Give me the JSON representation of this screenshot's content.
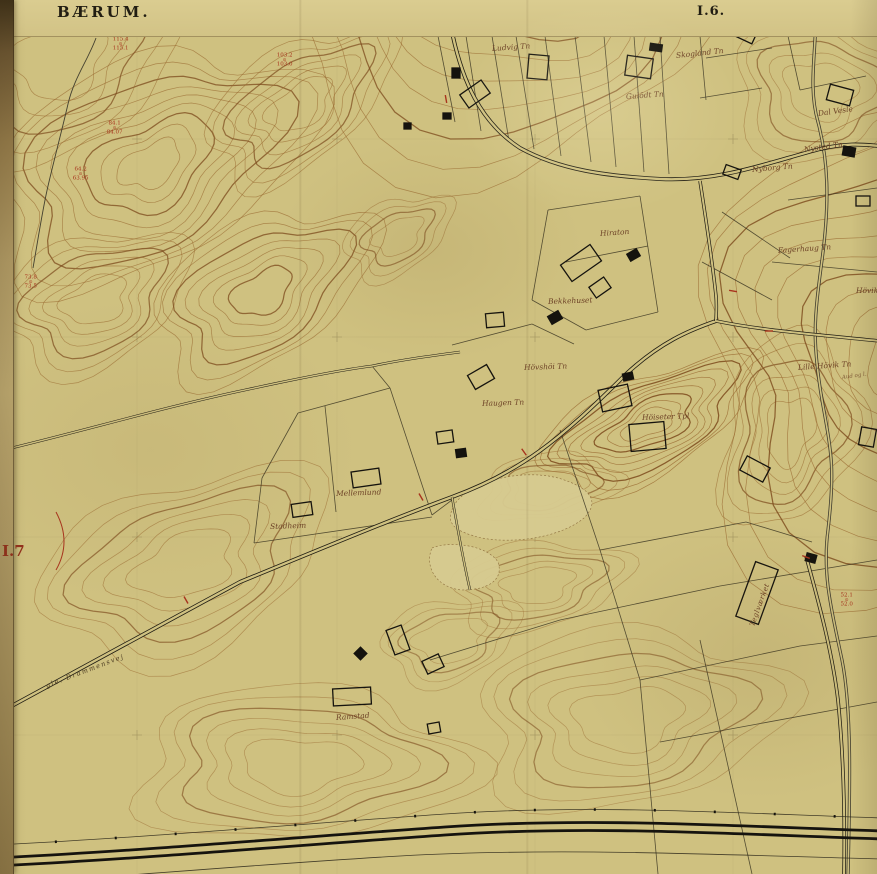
{
  "header": {
    "region_title": "BÆRUM.",
    "sheet_label": "I.6.",
    "adjacent_sheet_label": "I.7"
  },
  "map": {
    "colors": {
      "paper": "#cfc180",
      "contour": "#9a6a30",
      "contour_index": "#7c4a1c",
      "ink": "#1f1c12",
      "benchmark_red": "#a8331d",
      "label_brown": "#6d4226"
    },
    "place_labels": [
      {
        "text": "Ludvig Tn",
        "x": 492,
        "y": 44,
        "rot": -4,
        "cls": "p"
      },
      {
        "text": "Skogland Tn",
        "x": 676,
        "y": 51,
        "rot": -6,
        "cls": "p"
      },
      {
        "text": "Gulödt Tn",
        "x": 626,
        "y": 92,
        "rot": -4,
        "cls": "p"
      },
      {
        "text": "Dal Vesle",
        "x": 818,
        "y": 109,
        "rot": -8,
        "cls": "p"
      },
      {
        "text": "Nysted Tn",
        "x": 804,
        "y": 145,
        "rot": -8,
        "cls": "p"
      },
      {
        "text": "Nyborg Tn",
        "x": 752,
        "y": 165,
        "rot": -5,
        "cls": "p"
      },
      {
        "text": "Fagerhaug Tn",
        "x": 778,
        "y": 246,
        "rot": -4,
        "cls": "p"
      },
      {
        "text": "Hövik",
        "x": 856,
        "y": 286,
        "rot": 0,
        "cls": "p"
      },
      {
        "text": "Hiraton",
        "x": 600,
        "y": 229,
        "rot": -4,
        "cls": "p"
      },
      {
        "text": "Bekkehuset",
        "x": 548,
        "y": 297,
        "rot": -2,
        "cls": "p"
      },
      {
        "text": "Hövshöi Tn",
        "x": 524,
        "y": 363,
        "rot": -2,
        "cls": "p"
      },
      {
        "text": "Haugen Tn",
        "x": 482,
        "y": 399,
        "rot": -2,
        "cls": "p"
      },
      {
        "text": "Höiseter Tpl",
        "x": 642,
        "y": 413,
        "rot": -2,
        "cls": "p"
      },
      {
        "text": "Lille Hövik Tn",
        "x": 798,
        "y": 363,
        "rot": -4,
        "cls": "p"
      },
      {
        "text": "Aud og l.",
        "x": 842,
        "y": 375,
        "rot": -8,
        "cls": "ps"
      },
      {
        "text": "Mellemlund",
        "x": 336,
        "y": 489,
        "rot": -2,
        "cls": "p"
      },
      {
        "text": "Stadheim",
        "x": 270,
        "y": 522,
        "rot": -2,
        "cls": "p"
      },
      {
        "text": "Ramstad",
        "x": 336,
        "y": 713,
        "rot": -4,
        "cls": "p"
      },
      {
        "text": "Teglværket",
        "x": 752,
        "y": 622,
        "rot": -70,
        "cls": "pv"
      },
      {
        "text": "gle. Drammensvej",
        "x": 46,
        "y": 682,
        "rot": -21,
        "cls": "road"
      }
    ],
    "benchmarks": [
      {
        "x": 112,
        "y": 36,
        "top": "115.4",
        "bottom": "115.1"
      },
      {
        "x": 276,
        "y": 52,
        "top": "103.2",
        "bottom": "103.0"
      },
      {
        "x": 106,
        "y": 120,
        "top": "84.1",
        "bottom": "84.07"
      },
      {
        "x": 72,
        "y": 166,
        "top": "64.2",
        "bottom": "63.95"
      },
      {
        "x": 24,
        "y": 274,
        "top": "73.8",
        "bottom": "73.5"
      },
      {
        "x": 840,
        "y": 592,
        "top": "52.1",
        "bottom": "52.0"
      }
    ],
    "red_ticks": [
      {
        "x": 186,
        "y": 600,
        "r": 60
      },
      {
        "x": 421,
        "y": 497,
        "r": 60
      },
      {
        "x": 524,
        "y": 452,
        "r": 55
      },
      {
        "x": 733,
        "y": 291,
        "r": 10
      },
      {
        "x": 769,
        "y": 331,
        "r": 0
      },
      {
        "x": 806,
        "y": 557,
        "r": 20
      },
      {
        "x": 446,
        "y": 99,
        "r": 80
      }
    ],
    "buildings": [
      [
        452,
        68,
        8,
        10,
        0,
        1
      ],
      [
        462,
        86,
        26,
        16,
        -35,
        0
      ],
      [
        528,
        55,
        20,
        24,
        5,
        0
      ],
      [
        626,
        57,
        26,
        20,
        8,
        0
      ],
      [
        650,
        44,
        12,
        7,
        8,
        1
      ],
      [
        730,
        25,
        26,
        14,
        25,
        0
      ],
      [
        724,
        167,
        16,
        10,
        20,
        0
      ],
      [
        828,
        87,
        24,
        16,
        15,
        0
      ],
      [
        843,
        147,
        12,
        9,
        10,
        1
      ],
      [
        856,
        196,
        14,
        10,
        0,
        0
      ],
      [
        443,
        113,
        8,
        6,
        0,
        1
      ],
      [
        404,
        123,
        7,
        6,
        0,
        1
      ],
      [
        563,
        253,
        36,
        20,
        -35,
        0
      ],
      [
        628,
        251,
        11,
        8,
        -30,
        1
      ],
      [
        591,
        281,
        18,
        13,
        -35,
        0
      ],
      [
        486,
        313,
        18,
        14,
        -5,
        0
      ],
      [
        549,
        313,
        12,
        9,
        -30,
        1
      ],
      [
        470,
        369,
        22,
        16,
        -30,
        0
      ],
      [
        437,
        431,
        16,
        12,
        -8,
        0
      ],
      [
        456,
        449,
        10,
        8,
        -8,
        1
      ],
      [
        600,
        387,
        30,
        22,
        -12,
        0
      ],
      [
        623,
        373,
        10,
        7,
        -12,
        1
      ],
      [
        630,
        423,
        35,
        27,
        -5,
        0
      ],
      [
        742,
        461,
        26,
        16,
        28,
        0
      ],
      [
        352,
        470,
        28,
        16,
        -8,
        0
      ],
      [
        292,
        503,
        20,
        13,
        -8,
        0
      ],
      [
        745,
        564,
        24,
        58,
        20,
        0
      ],
      [
        806,
        554,
        10,
        8,
        15,
        1
      ],
      [
        333,
        688,
        38,
        17,
        -3,
        0
      ],
      [
        390,
        627,
        16,
        26,
        -20,
        0
      ],
      [
        424,
        657,
        18,
        14,
        -25,
        0
      ],
      [
        356,
        649,
        9,
        9,
        45,
        1
      ],
      [
        428,
        723,
        12,
        10,
        -10,
        0
      ],
      [
        860,
        428,
        15,
        18,
        10,
        0
      ]
    ]
  }
}
